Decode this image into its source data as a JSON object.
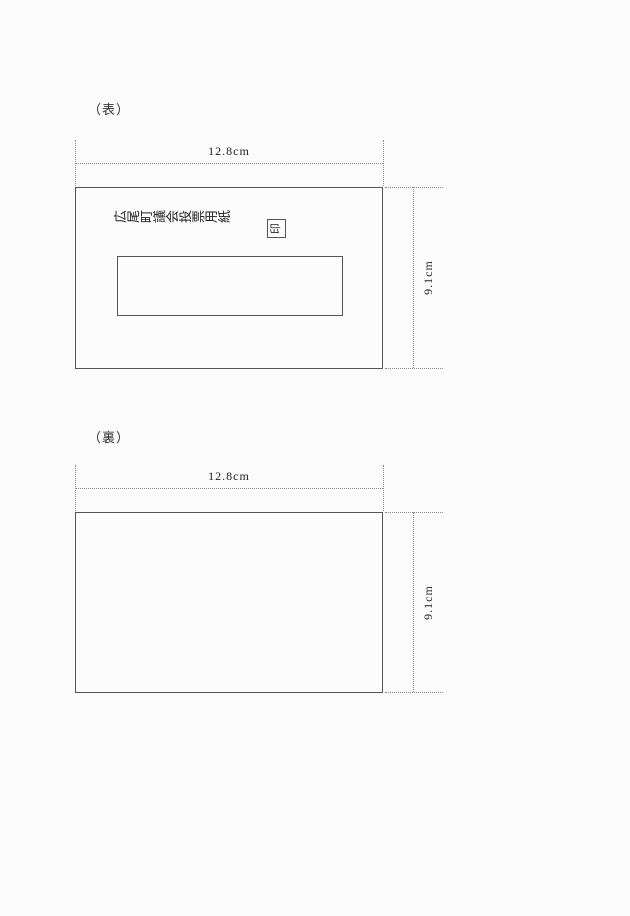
{
  "document": {
    "type": "ballot-paper-specification-figure",
    "background_color": "#fbfbfb",
    "line_color": "#555555",
    "guide_line_color": "#8a8a8a"
  },
  "front": {
    "side_label": "（表）",
    "width_dimension": "12.8cm",
    "height_dimension": "9.1cm",
    "ballot_title": "広尾町議会投票用紙",
    "seal_mark": "印"
  },
  "back": {
    "side_label": "（裏）",
    "width_dimension": "12.8cm",
    "height_dimension": "9.1cm"
  }
}
